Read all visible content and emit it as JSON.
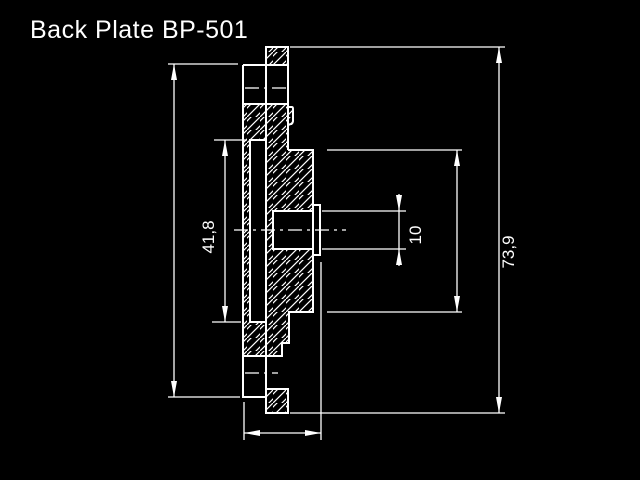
{
  "title": "Back Plate BP-501",
  "drawing": {
    "background": "#000000",
    "line_color": "#ffffff",
    "style": "engineering cross-section with diagonal hatching",
    "dimensions": {
      "groove": {
        "label": "41,8"
      },
      "bore": {
        "label": "10"
      },
      "overall": {
        "label": "73,9"
      }
    }
  }
}
